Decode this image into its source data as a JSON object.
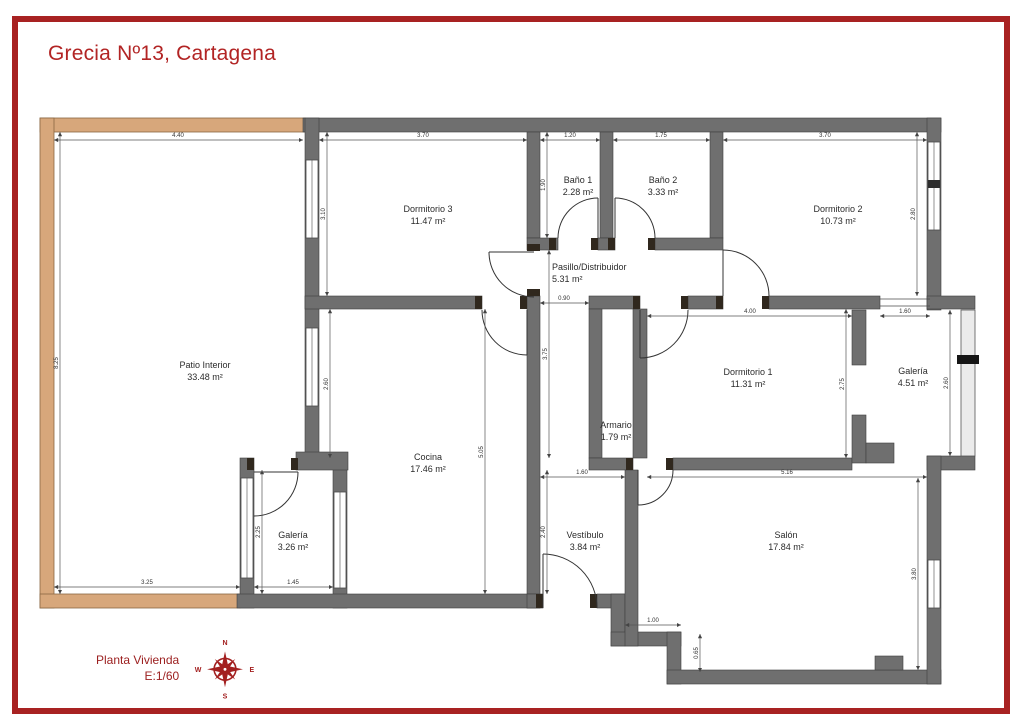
{
  "title": "Grecia Nº13, Cartagena",
  "footer": {
    "plan_label": "Planta Vivienda",
    "scale_label": "E:1/60"
  },
  "compass": {
    "n": "N",
    "e": "E",
    "s": "S",
    "w": "W"
  },
  "colors": {
    "accent_red": "#a82222",
    "wall_gray": "#6f6f6f",
    "patio_tan": "#d7a77b"
  },
  "rooms": [
    {
      "name": "Patio Interior",
      "area": "33.48 m²"
    },
    {
      "name": "Dormitorio 3",
      "area": "11.47 m²"
    },
    {
      "name": "Baño 1",
      "area": "2.28 m²"
    },
    {
      "name": "Baño 2",
      "area": "3.33 m²"
    },
    {
      "name": "Dormitorio 2",
      "area": "10.73 m²"
    },
    {
      "name": "Pasillo/Distribuidor",
      "area": "5.31 m²"
    },
    {
      "name": "Armario",
      "area": "1.79 m²"
    },
    {
      "name": "Dormitorio 1",
      "area": "11.31 m²"
    },
    {
      "name": "Galería",
      "area": "4.51 m²"
    },
    {
      "name": "Cocina",
      "area": "17.46 m²"
    },
    {
      "name": "Galería",
      "area": "3.26 m²"
    },
    {
      "name": "Vestíbulo",
      "area": "3.84 m²"
    },
    {
      "name": "Salón",
      "area": "17.84 m²"
    }
  ],
  "dimensions": {
    "top_patio": "4.40",
    "top_dorm3": "3.70",
    "top_bano1": "1.20",
    "top_bano2": "1.75",
    "top_dorm2": "3.70",
    "left_patio": "8.25",
    "dorm3_left": "3.10",
    "cocina_left": "2.60",
    "bano1_depth": "1.90",
    "dorm2_right": "2.80",
    "pasillo_width": "0.90",
    "pasillo_length": "3.75",
    "dorm1_top": "4.00",
    "galeria_top": "1.60",
    "dorm1_right": "2.75",
    "galeria_right": "2.60",
    "cocina_right": "5.05",
    "vestibulo_left": "2.40",
    "galeria_bl_left": "2.25",
    "galeria_bl_bottom": "1.45",
    "patio_bottom": "3.25",
    "vestibulo_top": "1.60",
    "salon_top": "5.16",
    "entry_step_w": "1.00",
    "entry_step_h": "0.65",
    "salon_right": "3.80"
  }
}
